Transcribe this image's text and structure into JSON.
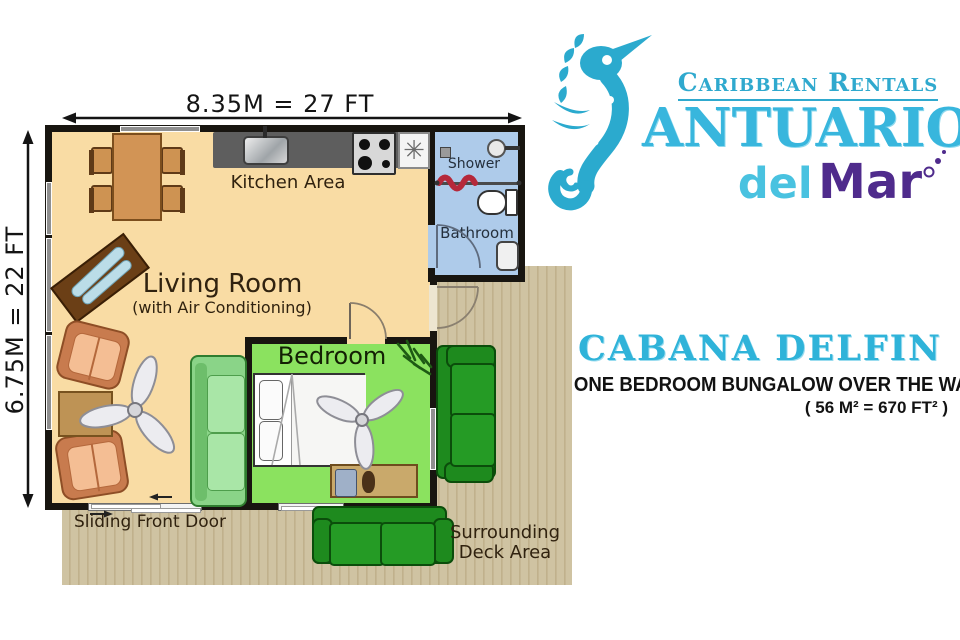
{
  "brand": {
    "tagline": "Caribbean Rentals",
    "name": "ANTUARIOS",
    "del": "del",
    "mar": "Mar",
    "seahorse_icon": "seahorse-logo",
    "colors": {
      "turquoise": "#2FA9CE",
      "name_blue": "#38B6DD",
      "del_blue": "#49C2E0",
      "mar_purple": "#4F2B8C"
    }
  },
  "listing": {
    "title": "CABANA DELFIN",
    "subtitle": "ONE BEDROOM BUNGALOW OVER THE WATER",
    "area": "( 56 M² = 670 FT² )"
  },
  "dimensions": {
    "width_label": "8.35M = 27 FT",
    "height_label": "6.75M = 22 FT"
  },
  "rooms": {
    "kitchen": "Kitchen Area",
    "living": "Living Room",
    "living_note": "(with Air Conditioning)",
    "bedroom": "Bedroom",
    "shower": "Shower",
    "bathroom": "Bathroom"
  },
  "labels": {
    "sliding_door": "Sliding Front Door",
    "deck_line1": "Surrounding",
    "deck_line2": "Deck Area"
  },
  "icons": {
    "appliance_glyph": "✳",
    "arrow_left": "←",
    "arrow_right": "→"
  },
  "palette": {
    "floor": "#F9DCA4",
    "bedroom_floor": "#8BE25F",
    "bathroom_floor": "#AECBEA",
    "deck": "#CBBD9B",
    "wall": "#181510",
    "counter": "#5E5E5E",
    "living_sofa": "#8AD488",
    "deck_couch": "#1E8A1E",
    "armchair": "#F4BE94",
    "wood": "#D29455",
    "curtain_red": "#B5283A"
  }
}
